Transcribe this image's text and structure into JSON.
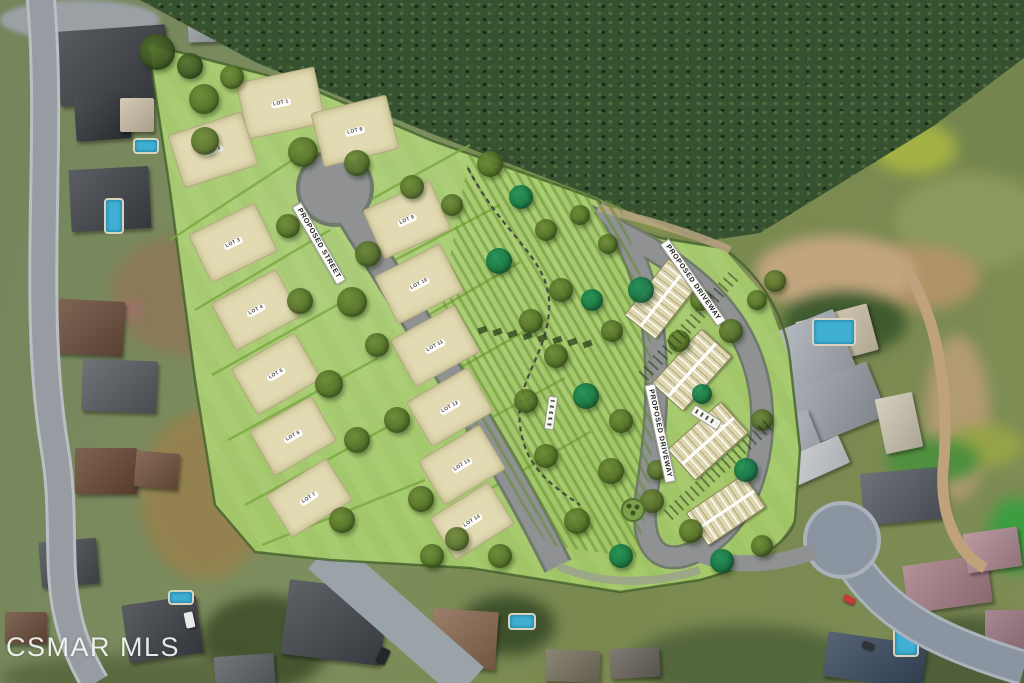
{
  "watermark": "CSMAR MLS",
  "site_plan": {
    "street_label": "PROPOSED STREET",
    "driveway_label_upper": "PROPOSED DRIVEWAY",
    "driveway_label_lower": "PROPOSED DRIVEWAY",
    "lots": [
      {
        "label": "LOT 1",
        "x": 281,
        "y": 103,
        "rot": -12,
        "w": 80,
        "h": 58
      },
      {
        "label": "LOT 2",
        "x": 213,
        "y": 150,
        "rot": -18,
        "w": 78,
        "h": 56
      },
      {
        "label": "LOT 3",
        "x": 233,
        "y": 243,
        "rot": -26,
        "w": 74,
        "h": 54
      },
      {
        "label": "LOT 4",
        "x": 256,
        "y": 310,
        "rot": -28,
        "w": 74,
        "h": 54
      },
      {
        "label": "LOT 5",
        "x": 276,
        "y": 374,
        "rot": -30,
        "w": 74,
        "h": 54
      },
      {
        "label": "LOT 6",
        "x": 293,
        "y": 436,
        "rot": -30,
        "w": 72,
        "h": 52
      },
      {
        "label": "LOT 7",
        "x": 309,
        "y": 498,
        "rot": -32,
        "w": 72,
        "h": 50
      },
      {
        "label": "LOT 8",
        "x": 355,
        "y": 131,
        "rot": -14,
        "w": 78,
        "h": 56
      },
      {
        "label": "LOT 9",
        "x": 407,
        "y": 220,
        "rot": -24,
        "w": 74,
        "h": 54
      },
      {
        "label": "LOT 10",
        "x": 419,
        "y": 284,
        "rot": -27,
        "w": 74,
        "h": 54
      },
      {
        "label": "LOT 11",
        "x": 435,
        "y": 346,
        "rot": -29,
        "w": 74,
        "h": 54
      },
      {
        "label": "LOT 12",
        "x": 450,
        "y": 407,
        "rot": -30,
        "w": 72,
        "h": 52
      },
      {
        "label": "LOT 13",
        "x": 462,
        "y": 465,
        "rot": -31,
        "w": 72,
        "h": 52
      },
      {
        "label": "LOT 14",
        "x": 472,
        "y": 521,
        "rot": -32,
        "w": 70,
        "h": 50
      }
    ],
    "townhomes": [
      {
        "x": 662,
        "y": 299,
        "w": 72,
        "h": 40,
        "rot": -52
      },
      {
        "x": 692,
        "y": 370,
        "w": 74,
        "h": 42,
        "rot": -48
      },
      {
        "x": 708,
        "y": 441,
        "w": 72,
        "h": 42,
        "rot": -42
      },
      {
        "x": 726,
        "y": 510,
        "w": 70,
        "h": 40,
        "rot": -34
      }
    ],
    "trees": [
      [
        157,
        52,
        18,
        "d"
      ],
      [
        190,
        66,
        13,
        "d"
      ],
      [
        204,
        99,
        15,
        "o"
      ],
      [
        205,
        141,
        14,
        "o"
      ],
      [
        232,
        77,
        12,
        "o"
      ],
      [
        303,
        152,
        15,
        "o"
      ],
      [
        357,
        163,
        13,
        "o"
      ],
      [
        412,
        187,
        12,
        "o"
      ],
      [
        452,
        205,
        11,
        "o"
      ],
      [
        288,
        226,
        12,
        "o"
      ],
      [
        368,
        254,
        13,
        "o"
      ],
      [
        300,
        301,
        13,
        "o"
      ],
      [
        352,
        302,
        15,
        "o"
      ],
      [
        329,
        384,
        14,
        "o"
      ],
      [
        377,
        345,
        12,
        "o"
      ],
      [
        357,
        440,
        13,
        "o"
      ],
      [
        397,
        420,
        13,
        "o"
      ],
      [
        342,
        520,
        13,
        "o"
      ],
      [
        421,
        499,
        13,
        "o"
      ],
      [
        457,
        539,
        12,
        "o"
      ],
      [
        500,
        556,
        12,
        "o"
      ],
      [
        432,
        556,
        12,
        "o"
      ],
      [
        490,
        164,
        13,
        "o"
      ],
      [
        521,
        197,
        12,
        "e"
      ],
      [
        546,
        230,
        11,
        "o"
      ],
      [
        499,
        261,
        13,
        "e"
      ],
      [
        561,
        290,
        12,
        "o"
      ],
      [
        531,
        321,
        12,
        "o"
      ],
      [
        592,
        300,
        11,
        "e"
      ],
      [
        556,
        356,
        12,
        "o"
      ],
      [
        612,
        331,
        11,
        "o"
      ],
      [
        526,
        401,
        12,
        "o"
      ],
      [
        586,
        396,
        13,
        "e"
      ],
      [
        621,
        421,
        12,
        "o"
      ],
      [
        546,
        456,
        12,
        "o"
      ],
      [
        611,
        471,
        13,
        "o"
      ],
      [
        652,
        501,
        12,
        "o"
      ],
      [
        577,
        521,
        13,
        "o"
      ],
      [
        621,
        556,
        12,
        "e"
      ],
      [
        641,
        290,
        13,
        "e"
      ],
      [
        701,
        300,
        11,
        "o"
      ],
      [
        731,
        331,
        12,
        "o"
      ],
      [
        679,
        341,
        11,
        "o"
      ],
      [
        757,
        300,
        10,
        "o"
      ],
      [
        762,
        420,
        11,
        "o"
      ],
      [
        746,
        470,
        12,
        "e"
      ],
      [
        702,
        394,
        10,
        "e"
      ],
      [
        691,
        531,
        12,
        "o"
      ],
      [
        657,
        470,
        10,
        "o"
      ],
      [
        722,
        561,
        12,
        "e"
      ],
      [
        762,
        546,
        11,
        "o"
      ],
      [
        775,
        281,
        11,
        "o"
      ],
      [
        608,
        244,
        10,
        "o"
      ],
      [
        580,
        215,
        10,
        "o"
      ]
    ],
    "vine_row": {
      "x": 478,
      "y": 327,
      "count": 8,
      "step": 15
    }
  },
  "photo": {
    "houses": [
      [
        58,
        28,
        110,
        75,
        -4,
        "#3d4046"
      ],
      [
        75,
        95,
        55,
        45,
        -4,
        "#2f3338"
      ],
      [
        70,
        168,
        80,
        62,
        -3,
        "#40444a"
      ],
      [
        120,
        98,
        34,
        34,
        0,
        "#cdc1a8"
      ],
      [
        52,
        300,
        72,
        55,
        3,
        "#6d4e3b"
      ],
      [
        82,
        360,
        75,
        52,
        2,
        "#585c62"
      ],
      [
        75,
        448,
        62,
        46,
        0,
        "#6a4936"
      ],
      [
        135,
        452,
        44,
        36,
        5,
        "#73543e"
      ],
      [
        40,
        540,
        58,
        46,
        -5,
        "#494d53"
      ],
      [
        125,
        600,
        75,
        58,
        -8,
        "#3e4248"
      ],
      [
        5,
        612,
        42,
        32,
        0,
        "#6d4e3b"
      ],
      [
        215,
        655,
        60,
        40,
        -4,
        "#5c6065"
      ],
      [
        285,
        585,
        100,
        75,
        7,
        "#43474d"
      ],
      [
        432,
        610,
        65,
        58,
        4,
        "#8a6950"
      ],
      [
        545,
        650,
        55,
        32,
        2,
        "#78725f"
      ],
      [
        610,
        648,
        50,
        30,
        -3,
        "#6b655c"
      ],
      [
        825,
        638,
        100,
        45,
        8,
        "#3a4a5e"
      ],
      [
        905,
        560,
        85,
        48,
        -8,
        "#a77f88"
      ],
      [
        965,
        530,
        55,
        40,
        -8,
        "#b08b92"
      ],
      [
        985,
        610,
        42,
        55,
        0,
        "#9a7680"
      ],
      [
        862,
        470,
        85,
        52,
        -5,
        "#555b63"
      ],
      [
        800,
        312,
        74,
        48,
        -15,
        "#d6ccb2"
      ],
      [
        775,
        320,
        72,
        62,
        -22,
        "#aeb3bb"
      ],
      [
        795,
        375,
        85,
        58,
        -22,
        "#9aa0a8"
      ],
      [
        762,
        418,
        55,
        42,
        -22,
        "#b7bcc4"
      ],
      [
        880,
        395,
        38,
        56,
        -12,
        "#cfc9b4"
      ],
      [
        758,
        452,
        90,
        30,
        -24,
        "#d3d6da"
      ],
      [
        188,
        16,
        42,
        26,
        -2,
        "#9aa0a6"
      ]
    ],
    "pools": [
      [
        133,
        138,
        26,
        16
      ],
      [
        104,
        198,
        20,
        36
      ],
      [
        168,
        590,
        26,
        15
      ],
      [
        508,
        613,
        28,
        17
      ],
      [
        812,
        318,
        44,
        28
      ],
      [
        893,
        625,
        26,
        32
      ]
    ],
    "cars": [
      [
        34,
        88,
        9,
        26,
        8,
        "#8fd0d6"
      ],
      [
        44,
        146,
        8,
        13,
        4,
        "#c23a3a"
      ],
      [
        50,
        162,
        8,
        12,
        2,
        "#993a3a"
      ],
      [
        185,
        612,
        9,
        16,
        -12,
        "#e9e9e9"
      ],
      [
        843,
        596,
        12,
        7,
        28,
        "#c33b3b"
      ],
      [
        862,
        642,
        12,
        7,
        20,
        "#2e3338"
      ],
      [
        820,
        528,
        7,
        12,
        0,
        "#d8d8d8"
      ],
      [
        378,
        648,
        10,
        16,
        25,
        "#23262a"
      ]
    ],
    "patches": [
      [
        110,
        235,
        150,
        120,
        "#8a7a58"
      ],
      [
        140,
        410,
        130,
        170,
        "#93824f"
      ],
      [
        35,
        30,
        75,
        40,
        "#5c6b43"
      ],
      [
        200,
        595,
        130,
        95,
        "#44552f"
      ],
      [
        630,
        625,
        230,
        75,
        "#54663c"
      ],
      [
        460,
        595,
        95,
        60,
        "#3f512c"
      ],
      [
        920,
        0,
        110,
        75,
        "#6f8048"
      ],
      [
        930,
        55,
        170,
        120,
        "#74864e"
      ],
      [
        980,
        250,
        90,
        230,
        "#7e8e55"
      ],
      [
        895,
        175,
        150,
        95,
        "#8b9a5d"
      ],
      [
        855,
        245,
        125,
        65,
        "#b09468"
      ],
      [
        755,
        235,
        160,
        75,
        "#c2a57e"
      ],
      [
        925,
        335,
        65,
        165,
        "#b29b73"
      ],
      [
        890,
        615,
        160,
        85,
        "#4e5f39"
      ],
      [
        0,
        655,
        270,
        45,
        "#5b6a41"
      ],
      [
        596,
        88,
        65,
        42,
        "#93a33e"
      ],
      [
        635,
        195,
        85,
        32,
        "#9aaa40"
      ],
      [
        872,
        122,
        85,
        52,
        "#a3b144"
      ],
      [
        948,
        425,
        75,
        42,
        "#96a348"
      ],
      [
        782,
        292,
        125,
        62,
        "#3f5a2e"
      ],
      [
        885,
        438,
        95,
        45,
        "#4f8f3d"
      ],
      [
        988,
        498,
        55,
        75,
        "#3c9e3f"
      ],
      [
        0,
        0,
        160,
        40,
        "#9aa0a4"
      ],
      [
        128,
        304,
        10,
        10,
        "#d8569b"
      ]
    ]
  },
  "colors": {
    "plan_grass": "#a8cd6d",
    "lot_pad": "#e2dab2",
    "street_gray": "#8f9192",
    "existing_asphalt": "#8b95a2",
    "brush": "#36512f",
    "dirt": "#c2a57e",
    "tree_olive": "#5d7c30",
    "tree_dark": "#445f26",
    "tree_emerald": "#13814c",
    "pool_blue": "#3fb0d4"
  }
}
